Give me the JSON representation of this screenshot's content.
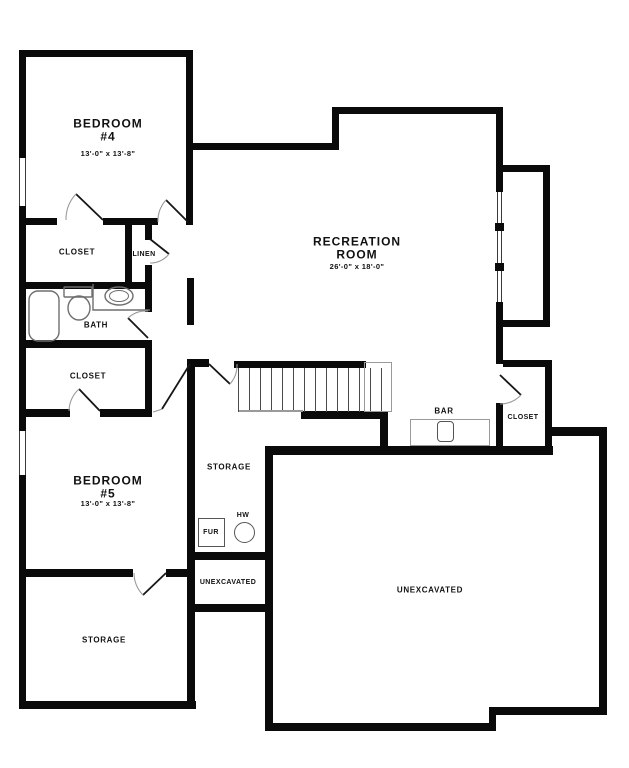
{
  "plan": {
    "type": "basement-floor-plan",
    "colors": {
      "wall": "#0a0a0a",
      "background": "#ffffff",
      "fixture_line": "#6e6e6e",
      "door_arc": "#9a9a9a",
      "text": "#111111"
    },
    "rooms": {
      "bedroom4": {
        "name": "BEDROOM\n#4",
        "dims": "13'-0\" x 13'-8\""
      },
      "recreation": {
        "name": "RECREATION\nROOM",
        "dims": "26'-0\" x 18'-0\""
      },
      "bedroom5": {
        "name": "BEDROOM\n#5",
        "dims": "13'-0\" x 13'-8\""
      },
      "closet_bed4": {
        "name": "CLOSET"
      },
      "linen": {
        "name": "LINEN"
      },
      "bath": {
        "name": "BATH"
      },
      "closet_bed5": {
        "name": "CLOSET"
      },
      "storage_hall": {
        "name": "STORAGE"
      },
      "furnace": {
        "name": "FUR"
      },
      "water_heater": {
        "name": "HW"
      },
      "unexcavated_left": {
        "name": "UNEXCAVATED"
      },
      "storage_lower": {
        "name": "STORAGE"
      },
      "bar": {
        "name": "BAR"
      },
      "closet_rec": {
        "name": "CLOSET"
      },
      "unexcavated_main": {
        "name": "UNEXCAVATED"
      }
    }
  }
}
